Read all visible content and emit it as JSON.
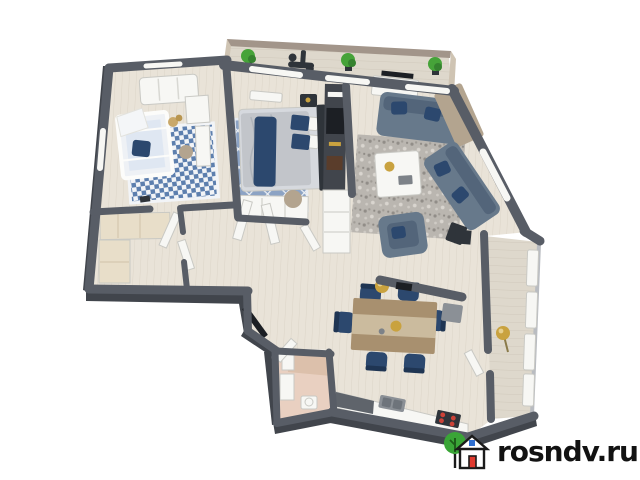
{
  "image": {
    "kind": "3d-rendered-apartment-floor-plan",
    "width": 640,
    "height": 480,
    "background": "#ffffff"
  },
  "watermark": {
    "text": "rosndv.ru",
    "logo": "house-with-tree-icon"
  },
  "palette": {
    "background": "#ffffff",
    "wall": "#585d66",
    "wall_dark": "#41454c",
    "wall_light": "#b9bcc1",
    "floor_wood": "#e9e3d8",
    "floor_line": "#dcd4c7",
    "balcony_floor": "#ded8cc",
    "balcony_wall": "#a2958a",
    "balcony_wall_light": "#cfc4b3",
    "bath_floor": "#e9d0c1",
    "bath_accent": "#dcc0ab",
    "closet_beige": "#e8dec9",
    "white": "#f7f7f4",
    "navy": "#2c486e",
    "sofa": "#67798b",
    "sofa_dark": "#53657a",
    "bed_gray": "#c2c5ca",
    "rug_blue": "#8ca3c4",
    "rug_gray": "#bab6b0",
    "wood_furn": "#a8906f",
    "wood_light": "#cbbb9e",
    "tan_furn": "#b3a48f",
    "mid_gray": "#8b9096",
    "gold": "#c9a23f",
    "plant": "#46a339",
    "plant_dark": "#35822f",
    "stove_red": "#cc4238",
    "dark_item": "#2f343a",
    "text": "#121212",
    "logo_green": "#3aa537",
    "logo_outline": "#1a1a1a",
    "logo_red": "#e03a2f",
    "logo_blue": "#2f6fd0"
  },
  "scene": {
    "rooms": [
      {
        "name": "top-balcony",
        "items": [
          "three-green-plants",
          "exercise-bike"
        ]
      },
      {
        "name": "nursery",
        "items": [
          "white-sofa",
          "crib",
          "checkered-blue-rug",
          "dresser",
          "desk",
          "teddy-bear"
        ]
      },
      {
        "name": "bedroom",
        "items": [
          "double-bed",
          "blue-diamond-rug",
          "dark-accent-wall",
          "white-wardrobe",
          "radiator"
        ]
      },
      {
        "name": "living-room",
        "items": [
          "tv-console",
          "two-gray-sofas",
          "navy-pillows",
          "mottled-rug",
          "coffee-table",
          "armchair",
          "tan-cabinet",
          "bay-window"
        ]
      },
      {
        "name": "hallway",
        "items": [
          "white-open-doors",
          "pouf",
          "entry-door"
        ]
      },
      {
        "name": "walk-in-closet",
        "items": [
          "beige-wardrobes"
        ]
      },
      {
        "name": "bathroom",
        "items": [
          "shower",
          "washbasin",
          "toilet"
        ]
      },
      {
        "name": "kitchen-dining",
        "items": [
          "dining-table",
          "six-navy-chairs",
          "gold-pendant",
          "counter-with-sink",
          "stove-red-burners"
        ]
      },
      {
        "name": "right-balcony",
        "items": [
          "glazing",
          "gold-floor-lamp"
        ]
      }
    ]
  }
}
